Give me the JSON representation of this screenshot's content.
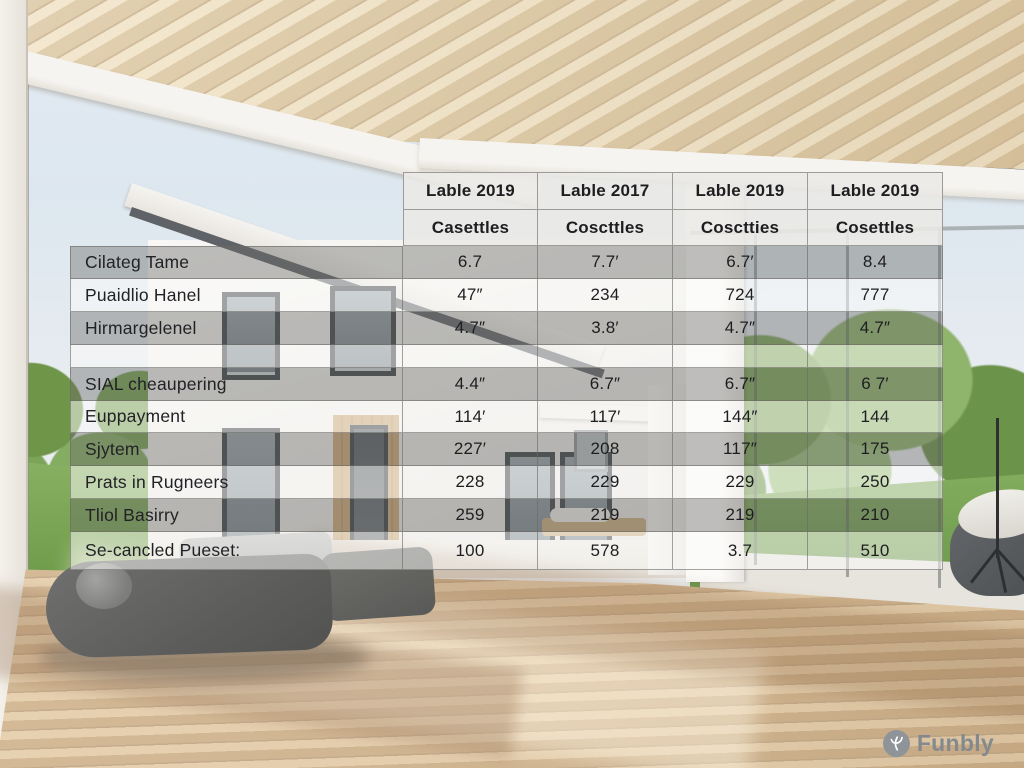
{
  "table": {
    "columns": [
      {
        "line1": "Lable 2019",
        "line2": "Casettles"
      },
      {
        "line1": "Lable 2017",
        "line2": "Coscttles"
      },
      {
        "line1": "Lable 2019",
        "line2": "Cosctties"
      },
      {
        "line1": "Lable 2019",
        "line2": "Cosettles"
      }
    ],
    "rows": [
      {
        "label": "Cilateg Tame",
        "band": "dark",
        "values": [
          "6.7",
          "7.7′",
          "6.7′",
          "8.4"
        ]
      },
      {
        "label": "Puaidlio Hanel",
        "band": "light",
        "values": [
          "47″",
          "234",
          "724",
          "777"
        ]
      },
      {
        "label": "Hirmargelenel",
        "band": "dark",
        "values": [
          "4.7″",
          "3.8′",
          "4.7″",
          "4.7″"
        ]
      },
      {
        "label": "",
        "band": "light",
        "values": [
          "",
          "",
          "",
          ""
        ]
      },
      {
        "label": "SIAL cheaupering",
        "band": "dark",
        "values": [
          "4.4″",
          "6.7″",
          "6.7″",
          "6 7′"
        ]
      },
      {
        "label": "Euppayment",
        "band": "light",
        "values": [
          "114′",
          "117′",
          "144″",
          "144"
        ]
      },
      {
        "label": "Sjytem",
        "band": "dark",
        "values": [
          "227′",
          "208",
          "117″",
          "175"
        ]
      },
      {
        "label": "Prats in Rugneers",
        "band": "light",
        "values": [
          "228",
          "229",
          "229",
          "250"
        ]
      },
      {
        "label": "Tliol Basirry",
        "band": "dark",
        "values": [
          "259",
          "219",
          "219",
          "210"
        ]
      },
      {
        "label": "Se-cancled Pueset:",
        "band": "light",
        "values": [
          "100",
          "578",
          "3.7",
          "510"
        ]
      }
    ]
  },
  "logo": {
    "text": "Funbly"
  },
  "colors": {
    "logo_grey": "#8e9498",
    "band_dark": "rgba(104,104,102,0.42)",
    "band_light": "rgba(252,252,250,0.52)"
  },
  "chart_data": {
    "type": "table",
    "title": "",
    "columns": [
      "",
      "Lable 2019 / Casettles",
      "Lable 2017 / Coscttles",
      "Lable 2019 / Cosctties",
      "Lable 2019 / Cosettles"
    ],
    "rows": [
      [
        "Cilateg Tame",
        "6.7",
        "7.7′",
        "6.7′",
        "8.4"
      ],
      [
        "Puaidlio Hanel",
        "47″",
        "234",
        "724",
        "777"
      ],
      [
        "Hirmargelenel",
        "4.7″",
        "3.8′",
        "4.7″",
        "4.7″"
      ],
      [
        "",
        "",
        "",
        "",
        ""
      ],
      [
        "SIAL cheaupering",
        "4.4″",
        "6.7″",
        "6.7″",
        "6 7′"
      ],
      [
        "Euppayment",
        "114′",
        "117′",
        "144″",
        "144"
      ],
      [
        "Sjytem",
        "227′",
        "208",
        "117″",
        "175"
      ],
      [
        "Prats in Rugneers",
        "228",
        "229",
        "229",
        "250"
      ],
      [
        "Tliol Basirry",
        "259",
        "219",
        "219",
        "210"
      ],
      [
        "Se-cancled Pueset:",
        "100",
        "578",
        "3.7",
        "510"
      ]
    ]
  }
}
